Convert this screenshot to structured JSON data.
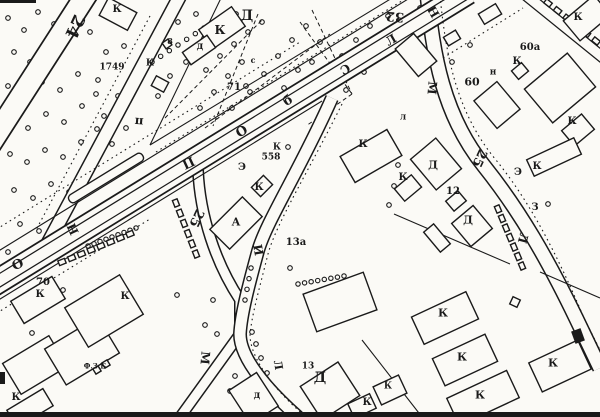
{
  "map": {
    "colors": {
      "ink": "#1a1a1a",
      "paper": "#fbfaf6"
    },
    "labels": [
      {
        "k": "st",
        "t": "24",
        "x": 74,
        "y": 26,
        "s": 17,
        "r": 115
      },
      {
        "k": "st",
        "t": "25",
        "x": 196,
        "y": 218,
        "s": 13,
        "r": 115
      },
      {
        "k": "st",
        "t": "25",
        "x": 479,
        "y": 158,
        "s": 13,
        "r": 115
      },
      {
        "k": "st",
        "t": "32",
        "x": 395,
        "y": 16,
        "s": 13,
        "r": 185
      },
      {
        "k": "st",
        "t": "О",
        "x": 18,
        "y": 265,
        "s": 13,
        "r": -25
      },
      {
        "k": "st",
        "t": "Н",
        "x": 73,
        "y": 229,
        "s": 12,
        "r": 245
      },
      {
        "k": "st",
        "t": "П",
        "x": 188,
        "y": 162,
        "s": 13,
        "r": 155
      },
      {
        "k": "st",
        "t": "О",
        "x": 242,
        "y": 132,
        "s": 13,
        "r": -30
      },
      {
        "k": "st",
        "t": "б",
        "x": 288,
        "y": 101,
        "s": 13,
        "r": -30
      },
      {
        "k": "st",
        "t": "С",
        "x": 345,
        "y": 69,
        "s": 12,
        "r": 150
      },
      {
        "k": "st",
        "t": "Л",
        "x": 391,
        "y": 40,
        "s": 12,
        "r": -30
      },
      {
        "k": "st",
        "t": "Н",
        "x": 433,
        "y": 12,
        "s": 12,
        "r": 60
      },
      {
        "k": "st",
        "t": "М",
        "x": 432,
        "y": 88,
        "s": 12,
        "r": 95
      },
      {
        "k": "st",
        "t": "Л",
        "x": 523,
        "y": 238,
        "s": 12,
        "r": 105
      },
      {
        "k": "st",
        "t": "И",
        "x": 258,
        "y": 250,
        "s": 12,
        "r": 80
      },
      {
        "k": "st",
        "t": "М",
        "x": 205,
        "y": 358,
        "s": 12,
        "r": 95
      },
      {
        "k": "st",
        "t": "Л",
        "x": 278,
        "y": 365,
        "s": 11,
        "r": 80
      },
      {
        "k": "st",
        "t": "п",
        "x": 139,
        "y": 122,
        "s": 12,
        "r": 185
      },
      {
        "k": "bl",
        "t": "К",
        "x": 117,
        "y": 10,
        "s": 10,
        "r": 0
      },
      {
        "k": "bl",
        "t": "1749",
        "x": 112,
        "y": 68,
        "s": 9,
        "r": 0
      },
      {
        "k": "bl",
        "t": "К",
        "x": 150,
        "y": 64,
        "s": 9,
        "r": 0
      },
      {
        "k": "bl",
        "t": "Д",
        "x": 247,
        "y": 16,
        "s": 14,
        "r": 0
      },
      {
        "k": "bl",
        "t": "К",
        "x": 220,
        "y": 30,
        "s": 12,
        "r": 0
      },
      {
        "k": "bl",
        "t": "д",
        "x": 200,
        "y": 47,
        "s": 10,
        "r": 0
      },
      {
        "k": "bl",
        "t": "8",
        "x": 170,
        "y": 41,
        "s": 8,
        "r": 0
      },
      {
        "k": "bl",
        "t": "с",
        "x": 253,
        "y": 60,
        "s": 8,
        "r": 0
      },
      {
        "k": "bl",
        "t": "71",
        "x": 234,
        "y": 88,
        "s": 10,
        "r": 0
      },
      {
        "k": "bl",
        "t": "К",
        "x": 277,
        "y": 148,
        "s": 9,
        "r": 0
      },
      {
        "k": "bl",
        "t": "558",
        "x": 271,
        "y": 158,
        "s": 9,
        "r": 0
      },
      {
        "k": "bl",
        "t": "Э",
        "x": 242,
        "y": 168,
        "s": 10,
        "r": 0
      },
      {
        "k": "bl",
        "t": "К",
        "x": 259,
        "y": 188,
        "s": 10,
        "r": 0
      },
      {
        "k": "bl",
        "t": "А",
        "x": 236,
        "y": 222,
        "s": 11,
        "r": 0
      },
      {
        "k": "bl",
        "t": "13а",
        "x": 296,
        "y": 243,
        "s": 10,
        "r": 0
      },
      {
        "k": "bl",
        "t": "70",
        "x": 43,
        "y": 283,
        "s": 10,
        "r": 0
      },
      {
        "k": "bl",
        "t": "К",
        "x": 40,
        "y": 295,
        "s": 10,
        "r": 0
      },
      {
        "k": "bl",
        "t": "К",
        "x": 125,
        "y": 297,
        "s": 10,
        "r": 0
      },
      {
        "k": "bl",
        "t": "К",
        "x": 16,
        "y": 398,
        "s": 10,
        "r": 0
      },
      {
        "k": "bl",
        "t": "Ф.З.Б",
        "x": 95,
        "y": 366,
        "s": 7,
        "r": 0
      },
      {
        "k": "bl",
        "t": "д",
        "x": 257,
        "y": 396,
        "s": 10,
        "r": 0
      },
      {
        "k": "bl",
        "t": "13",
        "x": 308,
        "y": 367,
        "s": 9,
        "r": 0
      },
      {
        "k": "bl",
        "t": "Д",
        "x": 320,
        "y": 378,
        "s": 14,
        "r": 0
      },
      {
        "k": "bl",
        "t": "К",
        "x": 388,
        "y": 387,
        "s": 9,
        "r": 0
      },
      {
        "k": "bl",
        "t": "К",
        "x": 367,
        "y": 403,
        "s": 10,
        "r": 0
      },
      {
        "k": "bl",
        "t": "К",
        "x": 443,
        "y": 313,
        "s": 11,
        "r": 0
      },
      {
        "k": "bl",
        "t": "К",
        "x": 462,
        "y": 357,
        "s": 11,
        "r": 0
      },
      {
        "k": "bl",
        "t": "К",
        "x": 480,
        "y": 395,
        "s": 11,
        "r": 0
      },
      {
        "k": "bl",
        "t": "К",
        "x": 553,
        "y": 363,
        "s": 11,
        "r": 0
      },
      {
        "k": "bl",
        "t": "Д",
        "x": 433,
        "y": 165,
        "s": 11,
        "r": 0
      },
      {
        "k": "bl",
        "t": "К",
        "x": 403,
        "y": 178,
        "s": 10,
        "r": 0
      },
      {
        "k": "bl",
        "t": "12",
        "x": 453,
        "y": 192,
        "s": 10,
        "r": 0
      },
      {
        "k": "bl",
        "t": "Д",
        "x": 468,
        "y": 220,
        "s": 11,
        "r": 0
      },
      {
        "k": "bl",
        "t": "Э",
        "x": 518,
        "y": 173,
        "s": 10,
        "r": 0
      },
      {
        "k": "bl",
        "t": "К",
        "x": 537,
        "y": 167,
        "s": 10,
        "r": 0
      },
      {
        "k": "bl",
        "t": "З",
        "x": 535,
        "y": 208,
        "s": 10,
        "r": 0
      },
      {
        "k": "bl",
        "t": "К",
        "x": 363,
        "y": 145,
        "s": 10,
        "r": 0
      },
      {
        "k": "bl",
        "t": "л",
        "x": 403,
        "y": 118,
        "s": 9,
        "r": 0
      },
      {
        "k": "bl",
        "t": "60",
        "x": 472,
        "y": 82,
        "s": 11,
        "r": 0
      },
      {
        "k": "bl",
        "t": "н",
        "x": 493,
        "y": 73,
        "s": 9,
        "r": 0
      },
      {
        "k": "bl",
        "t": "К",
        "x": 517,
        "y": 62,
        "s": 10,
        "r": 0
      },
      {
        "k": "bl",
        "t": "60а",
        "x": 530,
        "y": 48,
        "s": 10,
        "r": 0
      },
      {
        "k": "bl",
        "t": "К",
        "x": 578,
        "y": 18,
        "s": 10,
        "r": 0
      },
      {
        "k": "bl",
        "t": "К",
        "x": 572,
        "y": 122,
        "s": 10,
        "r": 0
      }
    ],
    "trees": {
      "r": 2.3,
      "groups": {
        "woods": [
          [
            8,
            18
          ],
          [
            24,
            30
          ],
          [
            38,
            12
          ],
          [
            54,
            24
          ],
          [
            14,
            52
          ],
          [
            30,
            62
          ],
          [
            48,
            50
          ],
          [
            66,
            40
          ],
          [
            8,
            86
          ],
          [
            24,
            94
          ],
          [
            42,
            82
          ],
          [
            60,
            90
          ],
          [
            78,
            74
          ],
          [
            12,
            120
          ],
          [
            28,
            128
          ],
          [
            46,
            114
          ],
          [
            64,
            122
          ],
          [
            82,
            106
          ],
          [
            96,
            94
          ],
          [
            10,
            154
          ],
          [
            27,
            162
          ],
          [
            45,
            150
          ],
          [
            63,
            157
          ],
          [
            81,
            142
          ],
          [
            97,
            129
          ],
          [
            14,
            190
          ],
          [
            33,
            198
          ],
          [
            51,
            184
          ],
          [
            69,
            192
          ],
          [
            87,
            177
          ],
          [
            20,
            224
          ],
          [
            39,
            231
          ],
          [
            57,
            218
          ],
          [
            8,
            252
          ],
          [
            27,
            258
          ],
          [
            90,
            32
          ],
          [
            106,
            52
          ],
          [
            98,
            80
          ],
          [
            124,
            46
          ],
          [
            132,
            80
          ],
          [
            118,
            96
          ],
          [
            104,
            116
          ],
          [
            126,
            128
          ],
          [
            112,
            144
          ]
        ],
        "park": [
          [
            162,
            32
          ],
          [
            178,
            22
          ],
          [
            196,
            14
          ],
          [
            186,
            62
          ],
          [
            170,
            76
          ],
          [
            158,
            96
          ],
          [
            206,
            70
          ],
          [
            220,
            56
          ],
          [
            234,
            44
          ],
          [
            248,
            32
          ],
          [
            262,
            22
          ],
          [
            242,
            62
          ],
          [
            228,
            76
          ],
          [
            214,
            92
          ],
          [
            200,
            108
          ],
          [
            232,
            108
          ],
          [
            250,
            92
          ],
          [
            264,
            74
          ],
          [
            278,
            56
          ],
          [
            292,
            40
          ],
          [
            306,
            26
          ],
          [
            320,
            42
          ],
          [
            298,
            70
          ],
          [
            284,
            88
          ],
          [
            270,
            106
          ],
          [
            312,
            62
          ],
          [
            328,
            74
          ],
          [
            342,
            56
          ],
          [
            356,
            40
          ],
          [
            370,
            26
          ],
          [
            346,
            90
          ],
          [
            332,
            106
          ],
          [
            364,
            72
          ],
          [
            380,
            56
          ],
          [
            388,
            16
          ],
          [
            252,
            118
          ],
          [
            280,
            118
          ],
          [
            236,
            14
          ]
        ],
        "misc": [
          [
            246,
            86
          ],
          [
            141,
            66
          ],
          [
            288,
            147
          ],
          [
            63,
            290
          ],
          [
            98,
            320
          ],
          [
            32,
            333
          ],
          [
            177,
            295
          ],
          [
            213,
            300
          ],
          [
            205,
            325
          ],
          [
            217,
            334
          ],
          [
            256,
            344
          ],
          [
            261,
            358
          ],
          [
            267,
            373
          ],
          [
            252,
            332
          ],
          [
            290,
            268
          ],
          [
            235,
            376
          ],
          [
            230,
            391
          ],
          [
            398,
            165
          ],
          [
            394,
            186
          ],
          [
            389,
            205
          ],
          [
            452,
            62
          ],
          [
            543,
            100
          ],
          [
            548,
            204
          ],
          [
            420,
            8
          ],
          [
            428,
            22
          ],
          [
            414,
            31
          ],
          [
            470,
            45
          ]
        ]
      }
    },
    "chains": [
      {
        "x1": 88,
        "y1": 246,
        "x2": 136,
        "y2": 228,
        "n": 9
      },
      {
        "x1": 298,
        "y1": 284,
        "x2": 344,
        "y2": 276,
        "n": 8
      },
      {
        "x1": 152,
        "y1": 62,
        "x2": 204,
        "y2": 28,
        "n": 7
      },
      {
        "x1": 251,
        "y1": 268,
        "x2": 245,
        "y2": 300,
        "n": 4
      }
    ],
    "ladders": [
      {
        "x1": 62,
        "y1": 262,
        "x2": 130,
        "y2": 234,
        "n": 8
      },
      {
        "x1": 176,
        "y1": 203,
        "x2": 196,
        "y2": 254,
        "n": 6
      },
      {
        "x1": 498,
        "y1": 209,
        "x2": 522,
        "y2": 266,
        "n": 7
      },
      {
        "x1": 548,
        "y1": 3,
        "x2": 596,
        "y2": 41,
        "n": 6
      }
    ]
  }
}
